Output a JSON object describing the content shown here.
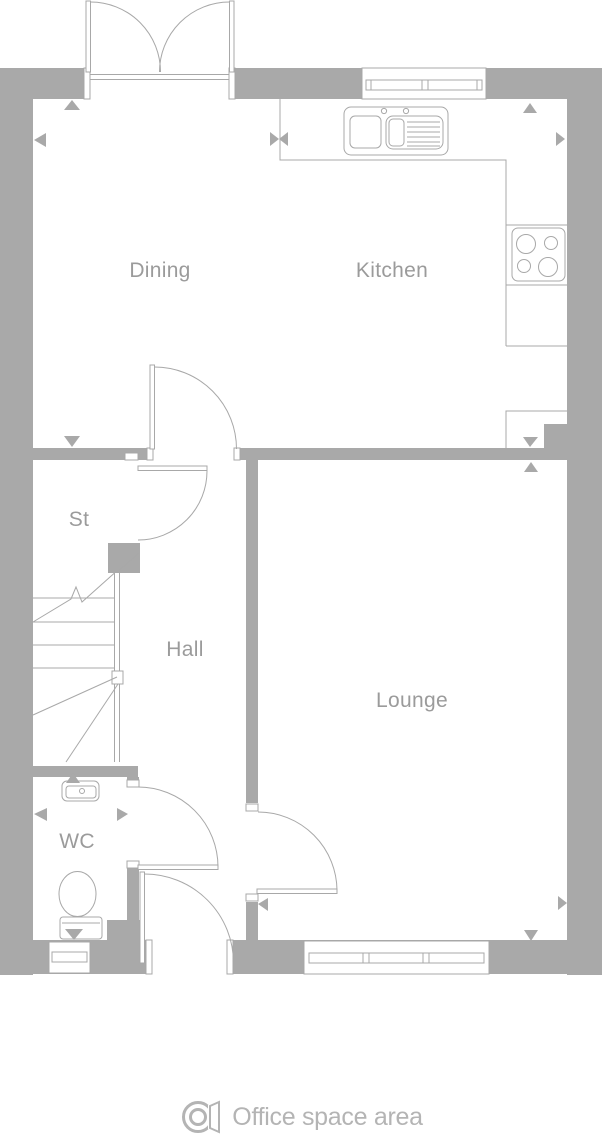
{
  "colors": {
    "wall": "#a9a9a9",
    "line": "#a8a8a8",
    "label": "#9b9b9b",
    "watermark": "#b4b4b4",
    "background": "#ffffff"
  },
  "floor_plan": {
    "title": "Ground floor plan",
    "rooms": [
      {
        "name": "dining",
        "label": "Dining"
      },
      {
        "name": "kitchen",
        "label": "Kitchen"
      },
      {
        "name": "store",
        "label": "St"
      },
      {
        "name": "hall",
        "label": "Hall"
      },
      {
        "name": "lounge",
        "label": "Lounge"
      },
      {
        "name": "wc",
        "label": "WC"
      }
    ],
    "fixtures": [
      "french-doors",
      "kitchen-window",
      "kitchen-sink",
      "hob",
      "worktop",
      "stairs",
      "store-door",
      "dining-hall-door",
      "wc-door",
      "front-door",
      "lounge-door",
      "toilet",
      "basin",
      "wc-window",
      "lounge-window",
      "dimension-arrows"
    ]
  },
  "footer": {
    "logo_icon": "office-space-area-logo",
    "text": "Office space area"
  }
}
